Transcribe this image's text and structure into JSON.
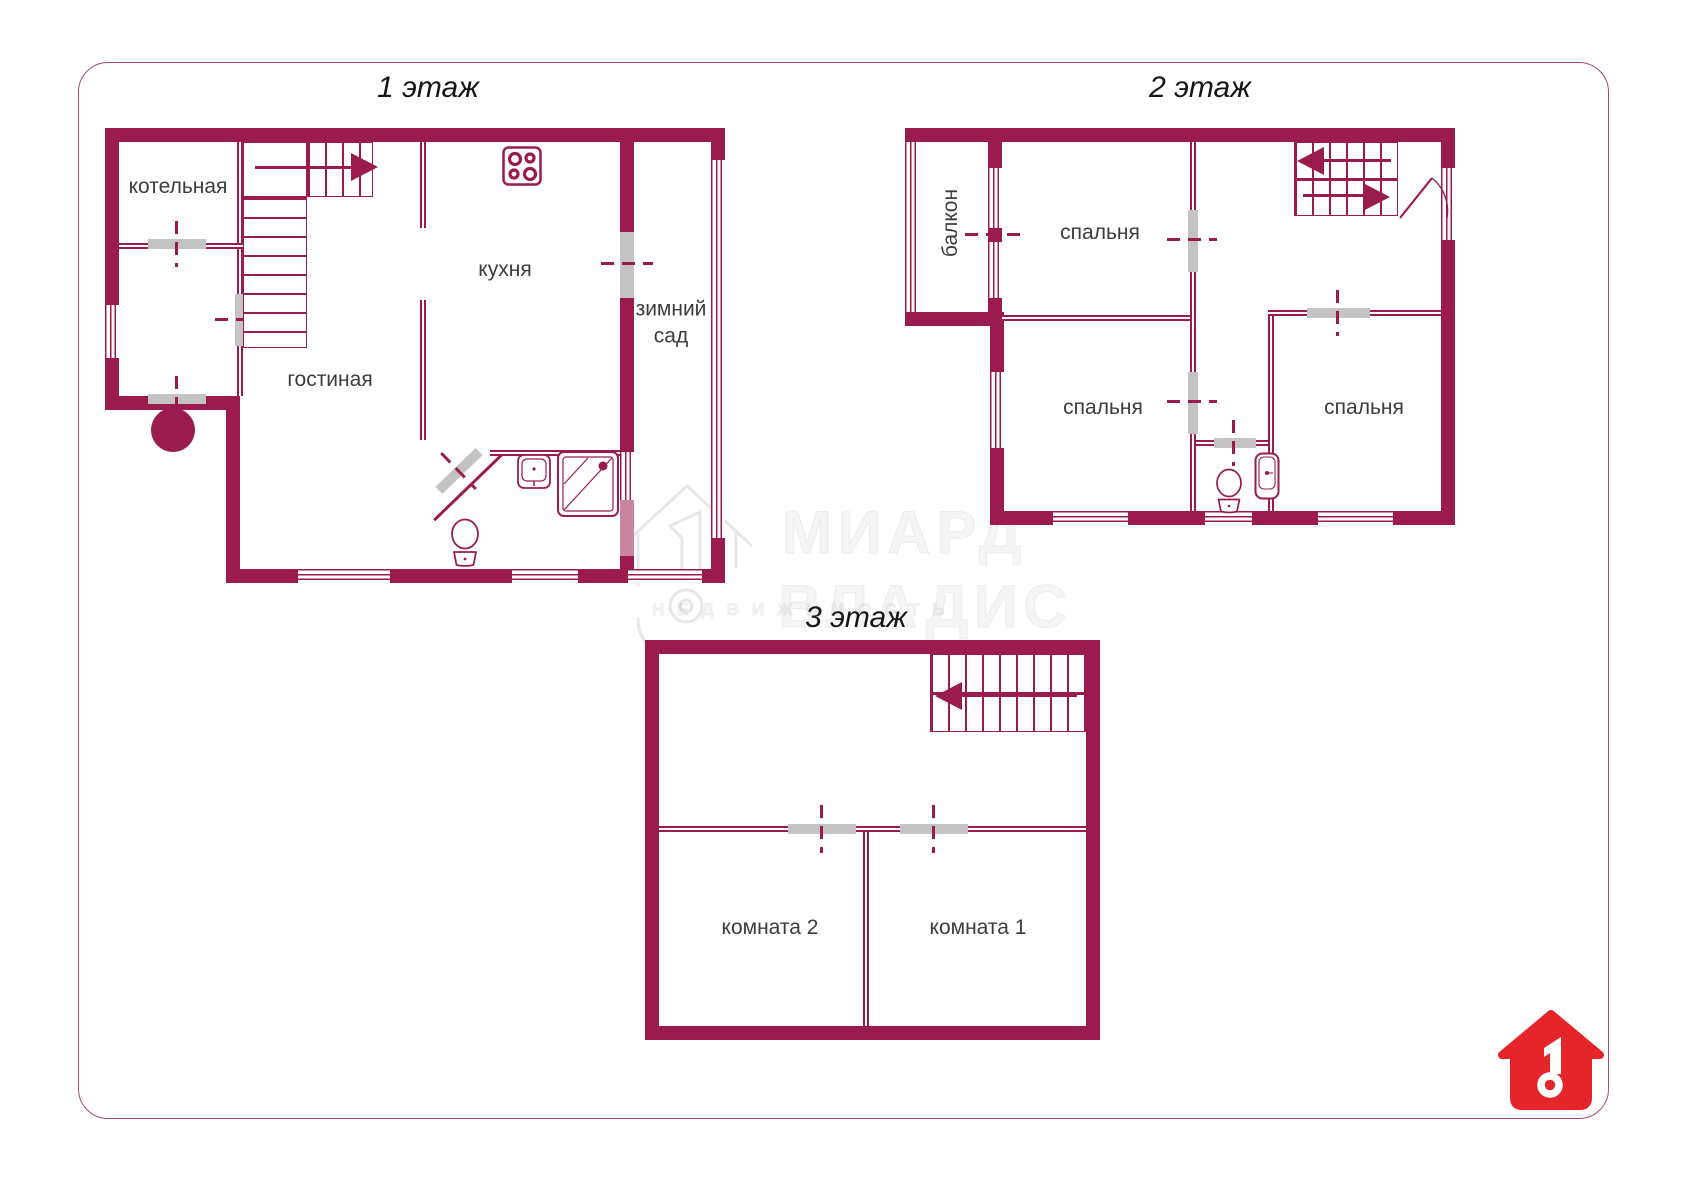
{
  "floors": [
    {
      "title": "1 этаж",
      "rooms": {
        "boiler": "котельная",
        "kitchen": "кухня",
        "living": "гостиная",
        "winter_garden": "зимний сад"
      }
    },
    {
      "title": "2 этаж",
      "rooms": {
        "balcony": "балкон",
        "bedroom_top": "спальня",
        "bedroom_left": "спальня",
        "bedroom_right": "спальня"
      }
    },
    {
      "title": "3 этаж",
      "rooms": {
        "room2": "комната 2",
        "room1": "комната 1"
      }
    }
  ],
  "watermark": {
    "brand_line1": "МИАРД",
    "brand_line2": "ВЛАДИС",
    "tagline": "недвижимость"
  },
  "colors": {
    "wall": "#9b1b4e",
    "wall_light": "#c9849f",
    "door_gray": "#c3c3c3",
    "logo_red": "#e6252b",
    "border": "#a84a6e",
    "label_text": "#3c3c3c",
    "title_text": "#151515"
  }
}
